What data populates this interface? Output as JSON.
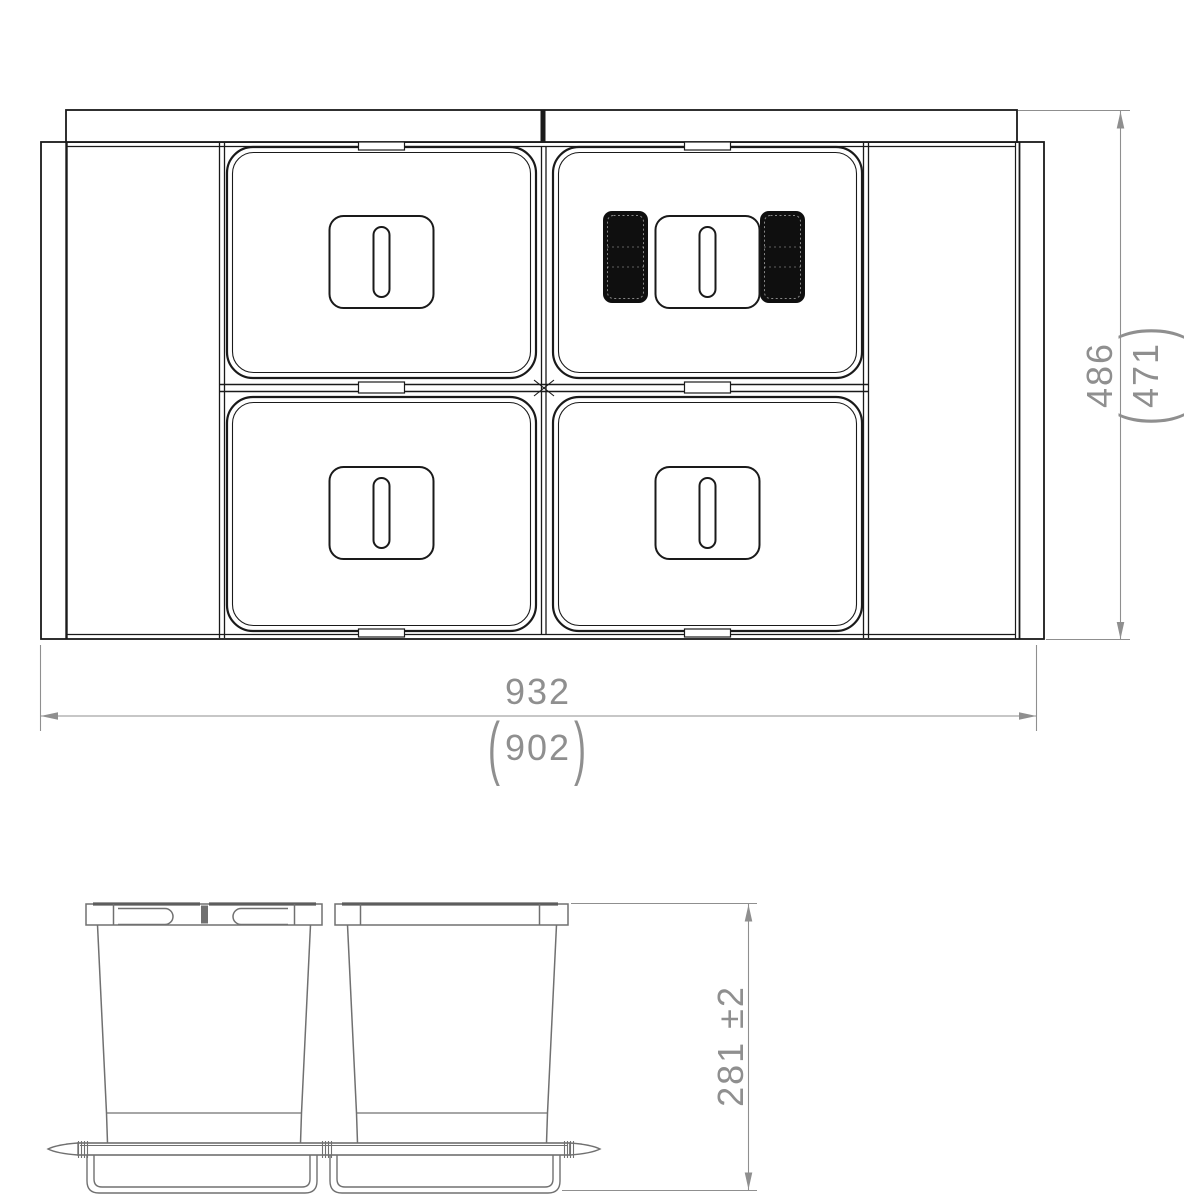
{
  "drawing": {
    "type": "technical-drawing",
    "views": {
      "plan": "plan-view-4-bin-drawer-unit",
      "front": "front-elevation-two-buckets-on-rail"
    },
    "dimensions": {
      "overall_width": {
        "value": "932",
        "alt_open": "(",
        "alt_value": "902",
        "alt_close": ")"
      },
      "overall_depth": {
        "value": "486",
        "alt_open": "(",
        "alt_value": "471",
        "alt_close": ")"
      },
      "bin_height": {
        "value": "281 ±2"
      }
    },
    "colors": {
      "plan_line": "#1a1a1a",
      "elevation_line": "#707070",
      "elevation_accent": "#5d5d5d",
      "dimension": "#8f8f8f",
      "pad": "#0f0f0f",
      "background": "#ffffff"
    }
  }
}
